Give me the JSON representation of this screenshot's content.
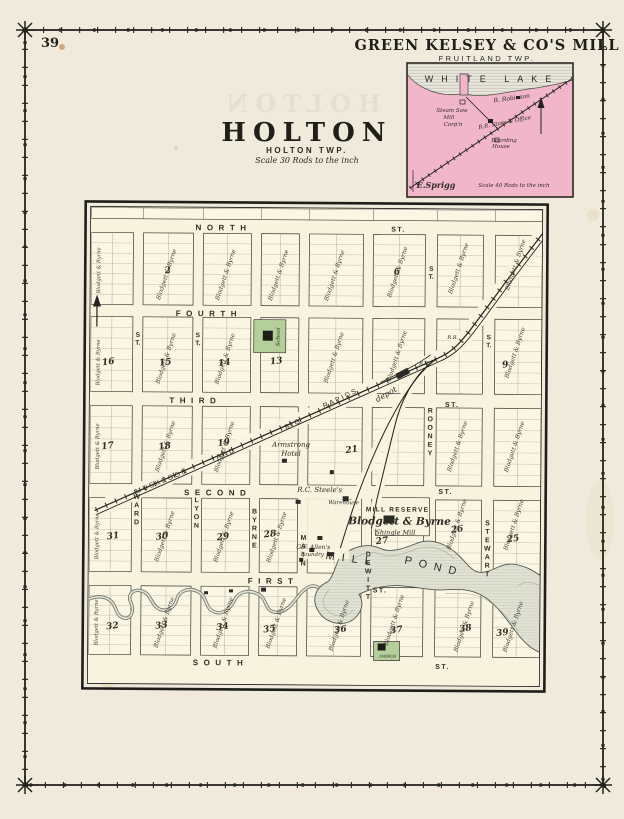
{
  "page": {
    "number": "39",
    "ghost": "HOLTON"
  },
  "palette": {
    "paper": "#efeadb",
    "map_paper": "#f7f3de",
    "block_fill": "#faf6e3",
    "inset_pink": "#f1b6c9",
    "lake_gray": "#e9e7dd",
    "pond": "#e1e2d4",
    "green_block": "#b5cf9b",
    "ink": "#2a2822"
  },
  "inset": {
    "title": "GREEN KELSEY & CO'S MILL",
    "twp": "FRUITLAND TWP.",
    "lake": "WHITE LAKE",
    "labels": [
      {
        "t": "R. Robinson",
        "x": 512,
        "y": 100,
        "r": -8,
        "s": 6,
        "i": 1
      },
      {
        "t": "Steam Saw",
        "x": 452,
        "y": 112,
        "s": 5.5,
        "i": 1
      },
      {
        "t": "Mill",
        "x": 449,
        "y": 119,
        "s": 5.5,
        "i": 1
      },
      {
        "t": "Corp'n",
        "x": 453,
        "y": 126,
        "s": 5.5,
        "i": 1
      },
      {
        "t": "R.R. Store & Office",
        "x": 505,
        "y": 124,
        "r": -11,
        "s": 5.5,
        "i": 1
      },
      {
        "t": "Boarding",
        "x": 504,
        "y": 142,
        "s": 5.5,
        "i": 1
      },
      {
        "t": "House",
        "x": 501,
        "y": 148,
        "s": 5.5,
        "i": 1
      },
      {
        "t": "E.Sprigg",
        "x": 436,
        "y": 188,
        "s": 8,
        "i": 1,
        "w": 1
      },
      {
        "t": "Scale 40 Rods to the inch",
        "x": 514,
        "y": 187,
        "s": 5.5,
        "i": 1
      }
    ]
  },
  "title_block": {
    "title": "HOLTON",
    "twp": "HOLTON TWP.",
    "scale": "Scale 30 Rods to the inch"
  },
  "map": {
    "buildings": {
      "school": "School",
      "church": "CHURCH"
    },
    "h_streets": [
      {
        "label": "NORTH",
        "x": 222,
        "y": 231
      },
      {
        "label": "FOURTH",
        "x": 208,
        "y": 317
      },
      {
        "label": "THIRD",
        "x": 195,
        "y": 404
      },
      {
        "label": "SECOND",
        "x": 218,
        "y": 496
      },
      {
        "label": "FIRST",
        "x": 274,
        "y": 584
      },
      {
        "label": "SOUTH",
        "x": 222,
        "y": 666
      }
    ],
    "st_marks": [
      {
        "x": 397,
        "y": 231
      },
      {
        "x": 452,
        "y": 406
      },
      {
        "x": 446,
        "y": 493
      },
      {
        "x": 381,
        "y": 592
      },
      {
        "x": 444,
        "y": 668
      }
    ],
    "v_streets": [
      {
        "label": "WARD",
        "x": 137,
        "y": 500
      },
      {
        "label": "LYON",
        "x": 197,
        "y": 503
      },
      {
        "label": "BYRNE",
        "x": 255,
        "y": 514
      },
      {
        "label": "MAIN",
        "x": 304,
        "y": 540
      },
      {
        "label": "DEWITT",
        "x": 369,
        "y": 556
      },
      {
        "label": "ROONEY",
        "x": 430,
        "y": 412
      },
      {
        "label": "STEWART",
        "x": 488,
        "y": 524
      }
    ],
    "v_st_marks": [
      {
        "x": 137,
        "y": 338
      },
      {
        "x": 197,
        "y": 338
      },
      {
        "x": 488,
        "y": 338
      },
      {
        "x": 430,
        "y": 270
      }
    ],
    "blocks": [
      {
        "n": "2",
        "x": 167,
        "y": 274
      },
      {
        "n": "6",
        "x": 396,
        "y": 274
      },
      {
        "n": "16",
        "x": 108,
        "y": 366
      },
      {
        "n": "15",
        "x": 165,
        "y": 366
      },
      {
        "n": "14",
        "x": 224,
        "y": 366
      },
      {
        "n": "13",
        "x": 276,
        "y": 364
      },
      {
        "n": "9",
        "x": 505,
        "y": 366
      },
      {
        "n": "17",
        "x": 108,
        "y": 450
      },
      {
        "n": "18",
        "x": 165,
        "y": 450
      },
      {
        "n": "19",
        "x": 224,
        "y": 446
      },
      {
        "n": "21",
        "x": 352,
        "y": 452
      },
      {
        "n": "31",
        "x": 114,
        "y": 540
      },
      {
        "n": "30",
        "x": 163,
        "y": 540
      },
      {
        "n": "29",
        "x": 224,
        "y": 540
      },
      {
        "n": "28",
        "x": 271,
        "y": 537
      },
      {
        "n": "27",
        "x": 383,
        "y": 543
      },
      {
        "n": "26",
        "x": 458,
        "y": 531
      },
      {
        "n": "25",
        "x": 514,
        "y": 540
      },
      {
        "n": "32",
        "x": 114,
        "y": 630
      },
      {
        "n": "33",
        "x": 163,
        "y": 629
      },
      {
        "n": "34",
        "x": 224,
        "y": 630
      },
      {
        "n": "35",
        "x": 271,
        "y": 632
      },
      {
        "n": "36",
        "x": 342,
        "y": 632
      },
      {
        "n": "37",
        "x": 398,
        "y": 632
      },
      {
        "n": "38",
        "x": 467,
        "y": 630
      },
      {
        "n": "39",
        "x": 504,
        "y": 634
      }
    ],
    "owners": [
      {
        "x": 167,
        "y": 276
      },
      {
        "x": 226,
        "y": 276
      },
      {
        "x": 279,
        "y": 276
      },
      {
        "x": 335,
        "y": 276
      },
      {
        "x": 398,
        "y": 272
      },
      {
        "x": 459,
        "y": 268
      },
      {
        "x": 516,
        "y": 264
      },
      {
        "x": 167,
        "y": 360
      },
      {
        "x": 226,
        "y": 360
      },
      {
        "x": 335,
        "y": 358
      },
      {
        "x": 398,
        "y": 356
      },
      {
        "x": 516,
        "y": 352
      },
      {
        "x": 167,
        "y": 448
      },
      {
        "x": 226,
        "y": 448
      },
      {
        "x": 459,
        "y": 446
      },
      {
        "x": 516,
        "y": 446
      },
      {
        "x": 167,
        "y": 538
      },
      {
        "x": 226,
        "y": 538
      },
      {
        "x": 279,
        "y": 538
      },
      {
        "x": 459,
        "y": 524
      },
      {
        "x": 516,
        "y": 524
      },
      {
        "x": 167,
        "y": 624
      },
      {
        "x": 226,
        "y": 624
      },
      {
        "x": 279,
        "y": 624
      },
      {
        "x": 342,
        "y": 626
      },
      {
        "x": 397,
        "y": 620
      },
      {
        "x": 467,
        "y": 626
      },
      {
        "x": 516,
        "y": 626
      },
      {
        "x": 99,
        "y": 272,
        "r": -90,
        "s": 5.2
      },
      {
        "x": 99,
        "y": 364,
        "r": -90,
        "s": 5.2
      },
      {
        "x": 99,
        "y": 448,
        "r": -90,
        "s": 5.2
      },
      {
        "x": 99,
        "y": 538,
        "r": -90,
        "s": 5.2
      },
      {
        "x": 99,
        "y": 624,
        "r": -90,
        "s": 5.2
      }
    ],
    "owner_text": "Blodgett & Byrne",
    "labels": [
      {
        "t": "depot",
        "x": 387,
        "y": 396,
        "r": -30,
        "s": 8,
        "i": 1
      },
      {
        "t": "R.R.",
        "x": 452,
        "y": 338,
        "s": 5,
        "i": 1
      },
      {
        "t": "R.R.",
        "x": 424,
        "y": 364,
        "s": 5,
        "i": 1
      },
      {
        "t": "Armstrong",
        "x": 291,
        "y": 447,
        "s": 7,
        "i": 1
      },
      {
        "t": "Hotel",
        "x": 291,
        "y": 456,
        "s": 7,
        "i": 1
      },
      {
        "t": "R.C. Steele's",
        "x": 320,
        "y": 492,
        "s": 7,
        "i": 1
      },
      {
        "t": "Warehouse",
        "x": 344,
        "y": 504,
        "s": 5.5,
        "i": 1
      },
      {
        "t": "MILL RESERVE",
        "x": 398,
        "y": 511,
        "s": 6.5,
        "sp": 1.3,
        "f": "sans",
        "w": 1
      },
      {
        "t": "Blodgett & Byrne",
        "x": 400,
        "y": 524,
        "s": 10.5,
        "i": 1,
        "w": 1
      },
      {
        "t": "Shingle Mill",
        "x": 396,
        "y": 534,
        "s": 6.5,
        "i": 1
      },
      {
        "t": "G.F. Allen's",
        "x": 314,
        "y": 549,
        "s": 6,
        "i": 1
      },
      {
        "t": "Foundry",
        "x": 313,
        "y": 556,
        "s": 5.5,
        "i": 1
      },
      {
        "t": "MILL",
        "x": 352,
        "y": 562,
        "r": 7,
        "s": 11,
        "sp": 7,
        "f": "sans"
      },
      {
        "t": "POND",
        "x": 434,
        "y": 569,
        "r": 12,
        "s": 11,
        "sp": 7,
        "f": "sans"
      },
      {
        "t": "MUSKEGON",
        "x": 163,
        "y": 484,
        "r": -23,
        "s": 7,
        "sp": 2,
        "f": "sans"
      },
      {
        "t": "AND",
        "x": 227,
        "y": 456,
        "r": -23,
        "s": 7,
        "sp": 2,
        "f": "sans"
      },
      {
        "t": "BIG",
        "x": 294,
        "y": 426,
        "r": -26,
        "s": 7,
        "sp": 2,
        "f": "sans"
      },
      {
        "t": "RAPIDS",
        "x": 341,
        "y": 400,
        "r": -26,
        "s": 7,
        "sp": 2,
        "f": "sans"
      }
    ]
  }
}
